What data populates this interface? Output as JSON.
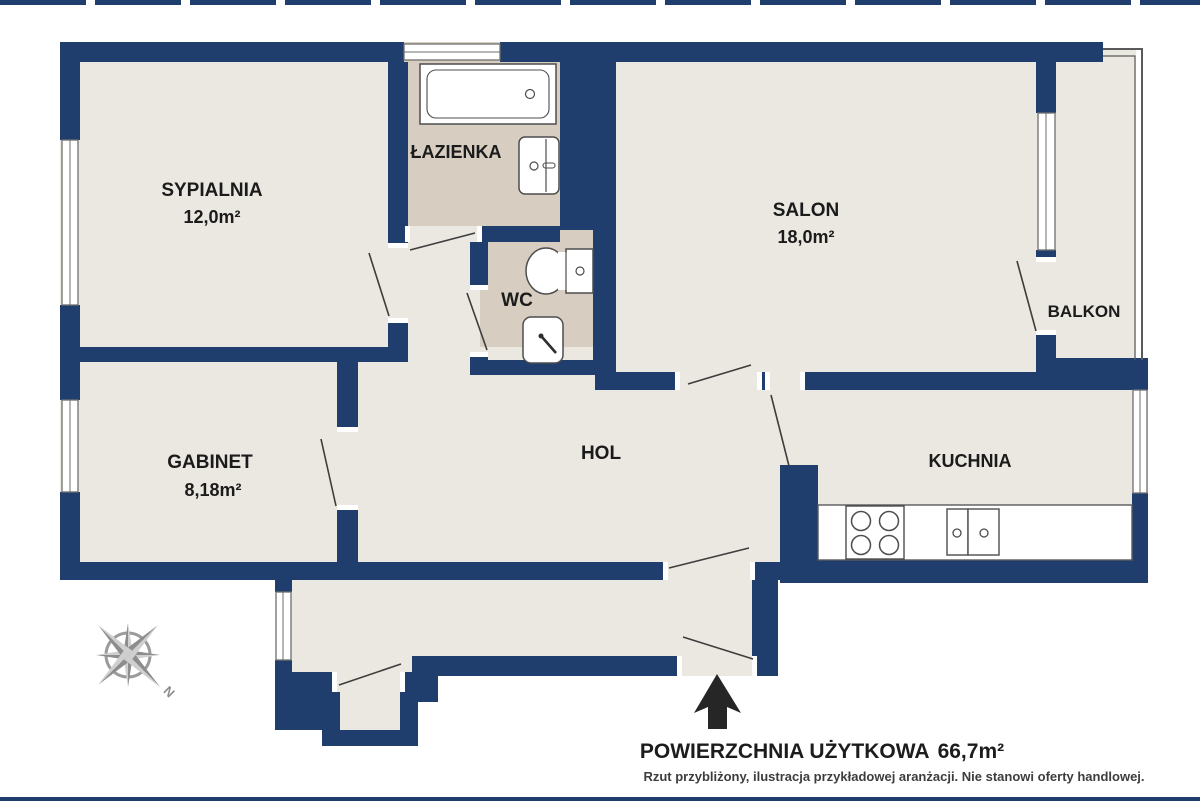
{
  "plan": {
    "rooms": {
      "sypialnia": {
        "name": "SYPIALNIA",
        "area": "12,0m²"
      },
      "lazienka": {
        "name": "ŁAZIENKA"
      },
      "salon": {
        "name": "SALON",
        "area": "18,0m²"
      },
      "balkon": {
        "name": "BALKON"
      },
      "wc": {
        "name": "WC"
      },
      "gabinet": {
        "name": "GABINET",
        "area": "8,18m²"
      },
      "hol": {
        "name": "HOL"
      },
      "kuchnia": {
        "name": "KUCHNIA"
      }
    },
    "compass": {
      "north_label": "N"
    },
    "footer": {
      "title_label": "POWIERZCHNIA UŻYTKOWA",
      "title_value": "66,7m²",
      "disclaimer": "Rzut przybliżony, ilustracja przykładowej aranżacji. Nie stanowi oferty handlowej."
    },
    "colors": {
      "wall": "#1f3e6d",
      "floor": "#ebe8e1",
      "wet_floor": "#d7cec1",
      "arrow": "#262626"
    }
  }
}
